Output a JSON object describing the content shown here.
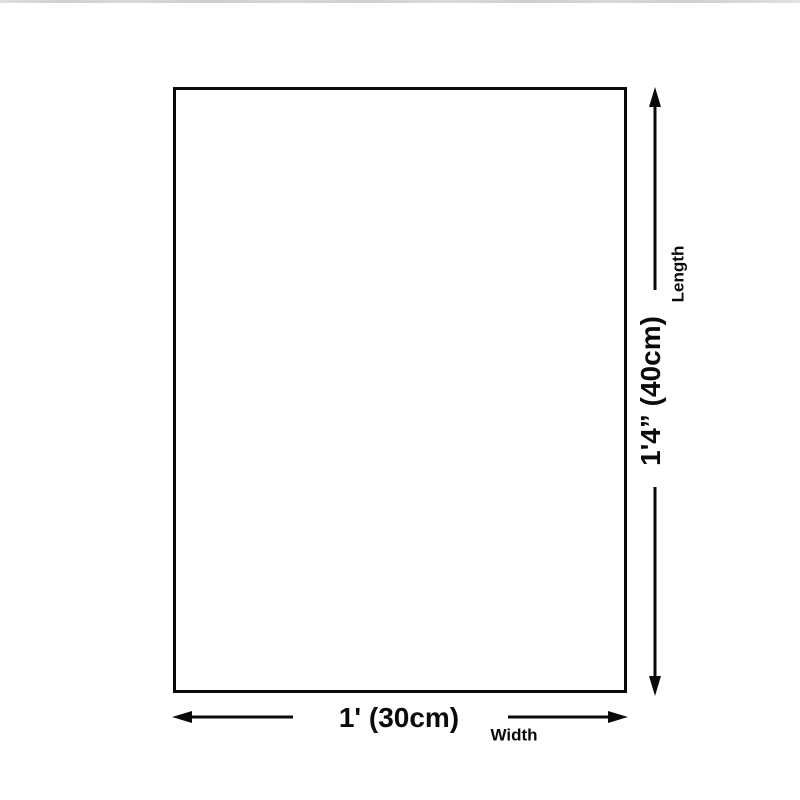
{
  "page": {
    "background_color": "#ffffff",
    "top_edge_artifact_color": "#cdcbc8"
  },
  "diagram": {
    "title": "product-dimensions-diagram",
    "line_color": "#0a0a0a",
    "length": {
      "value": "1'4” (40cm)",
      "label": "Length"
    },
    "width": {
      "value": "1' (30cm)",
      "label": "Width"
    }
  }
}
